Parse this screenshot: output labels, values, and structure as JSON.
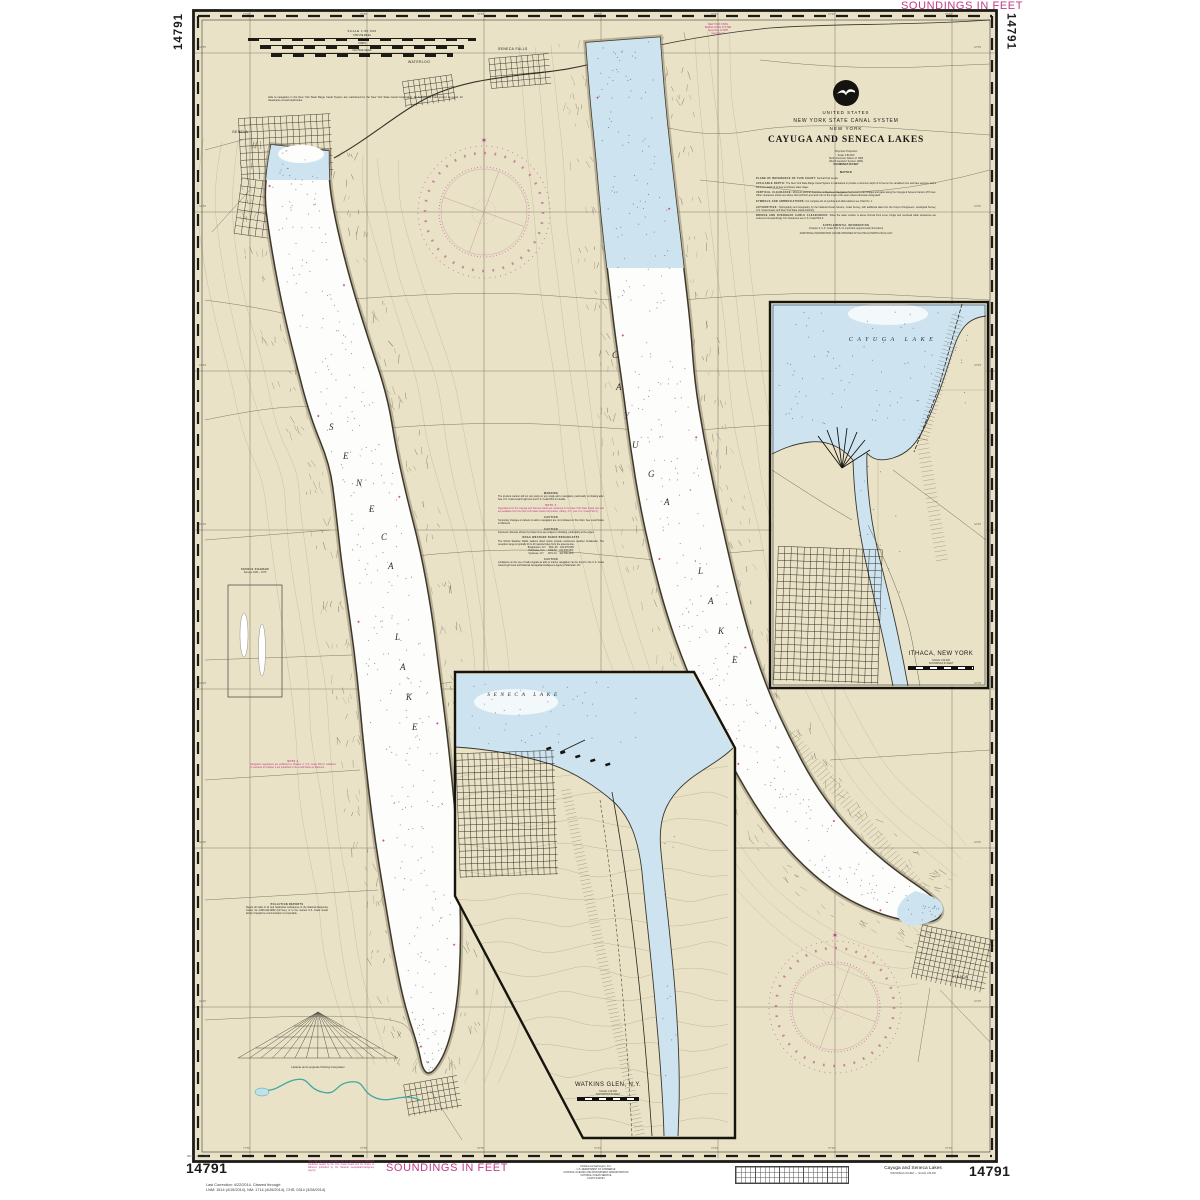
{
  "margins": {
    "top_left_number": "14791",
    "top_right_soundings": "SOUNDINGS IN FEET",
    "top_right_number": "14791",
    "bottom_left_edition": "4th Ed., Dec. '09",
    "bottom_left_number": "14791",
    "correction_line1": "Last Correction: 4/22/2014.  Cleared through:",
    "correction_line2": "LNM: 1514 (4/15/2014), NM: 1714 (4/26/2014), CHS: 0314 (3/28/2014)",
    "bottom_magenta_note": "This chart has been corrected from the Local Notice to Mariners published weekly by the U.S. Coast Guard and the Notice to Mariners published by the National Geospatial-Intelligence Agency.",
    "bottom_soundings": "SOUNDINGS IN FEET",
    "publisher_lines": [
      "Published at Washington, D.C.",
      "U.S. DEPARTMENT OF COMMERCE",
      "NATIONAL OCEANIC AND ATMOSPHERIC ADMINISTRATION",
      "NATIONAL OCEAN SERVICE",
      "COAST SURVEY"
    ],
    "bottom_right_title": "Cayuga and Seneca Lakes",
    "bottom_right_subtitle": "SOUNDINGS IN FEET — SCALE 1:80,000",
    "bottom_right_number": "14791"
  },
  "title_block": {
    "country": "UNITED STATES",
    "system": "NEW YORK STATE CANAL SYSTEM",
    "state": "NEW YORK",
    "title": "CAYUGA  AND  SENECA  LAKES",
    "projection_lines": [
      "Polyconic Projection",
      "Scale 1:80,000",
      "North American Datum of 1983",
      "(World Geodetic System 1984)",
      "SOUNDINGS IN FEET"
    ],
    "notes_header": "NOTES",
    "notes": [
      {
        "lead": "PLANE OF REFERENCE OF THIS CHART:",
        "body": " Normal Pool Levels."
      },
      {
        "lead": "AVAILABLE DEPTH:",
        "body": " The New York State Barge Canal System is maintained to provide a minimum depth of 12 feet in the canalized river and lake sections, and a minimum depth of 12 feet at ordinary water stage."
      },
      {
        "lead": "VERTICAL CLEARANCE:",
        "body": " Minimum vertical clearance at Maximum Navigable Pool Level under bridges and gates along the Cayuga & Seneca Canal is 15½ feet. Other clearances shown are above Normal Pool Level and refer to the mean of the span unless otherwise designated."
      },
      {
        "lead": "SYMBOLS AND ABBREVIATIONS:",
        "body": " For complete list of symbols and abbreviations see Chart No. 1."
      },
      {
        "lead": "AUTHORITIES:",
        "body": " Hydrography and topography by the National Ocean Service, Coast Survey, with additional data from the Corps of Engineers, Geological Survey, U.S. Coast Guard, and New York State Canal Authority."
      },
      {
        "lead": "BRIDGE AND OVERHEAD CABLE CLEARANCES:",
        "body": " When the water surface is above Normal Pool Level, bridge and overhead cable clearances are reduced correspondingly. For clearances see U.S. Coast Pilot 6."
      }
    ],
    "supplemental_header": "SUPPLEMENTAL INFORMATION",
    "supplemental_line": "(Chapter 9, U.S. Coast Pilot 6, for important supplemental information)",
    "supplemental_line2": "ADDITIONAL INFORMATION CAN BE OBTAINED AT NAUTICALCHARTS.NOAA.GOV"
  },
  "scale_block": {
    "scale": "SCALE 1:80,000",
    "bars": [
      "STATUTE MILES",
      "YARDS",
      "NAUTICAL MILES"
    ],
    "note": "Aids to navigation in the New York State Barge Canal System are maintained by the New York State Canal Corporation. All bridges are fixed except as noted; for clearances consult authorities."
  },
  "canal_note_lines": [
    "NEW YORK STATE",
    "BARGE CANAL SYSTEM",
    "Speed limit 10 MPH",
    "(see Note C)"
  ],
  "notes_center": {
    "blocks": [
      {
        "header": "WARNING",
        "body": "The prudent mariner will not rely solely on any single aid to navigation, particularly on floating aids. See U.S. Coast Guard Light List and U.S. Coast Pilot for details."
      },
      {
        "header": "NOTE C",
        "body": "Regulations for the Cayuga and Seneca Canal are contained in the New York State Canal Law and are available from the New York State Canal Corporation, Albany, N.Y. (see U.S. Coast Pilot 6)."
      },
      {
        "header": "CAUTION",
        "body": "Temporary changes or defects in aids to navigation are not indicated on this chart. See Local Notice to Mariners."
      },
      {
        "header": "CAUTION",
        "body": "Improved channels shown by broken lines are subject to shoaling, particularly at the edges."
      },
      {
        "header": "NOAA WEATHER RADIO BROADCASTS",
        "body": "The NOAA Weather Radio stations listed below provide continuous weather broadcasts. The reception range is typically 20 to 40 nautical miles from the antenna site.",
        "table": [
          "Binghamton, N.Y.    WXL-38    162.475 MHz",
          "Rochester, N.Y.     KHA-53    162.400 MHz",
          "Syracuse, N.Y.      WXL-31    162.550 MHz"
        ]
      },
      {
        "header": "CAUTION",
        "body": "Limitations on the use of radio signals as aids to marine navigation can be found in the U.S. Coast Guard Light Lists and National Geospatial-Intelligence Agency Publication 117."
      }
    ]
  },
  "side_notes": {
    "note_a_header": "NOTE A",
    "note_a_body": "Navigation regulations are published in Chapter 2, U.S. Coast Pilot 6. Additions or revisions to Chapter 2 are published in the Local Notice to Mariners.",
    "pollution_header": "POLLUTION REPORTS",
    "pollution_body": "Report all spills of oil and hazardous substances to the National Response Center via 1-800-424-8802 (toll free), or to the nearest U.S. Coast Guard facility if telephone communication is impossible.",
    "source_header": "SOURCE DIAGRAM",
    "source_sub": "Surveys 1934 – 1975",
    "interpolator_label": "Latitude and Longitude Plotting Interpolator"
  },
  "map_labels": {
    "seneca_lake": "SENECA LAKE",
    "cayuga_lake": "CAYUGA LAKE",
    "geneva": "GENEVA",
    "waterloo": "WATERLOO",
    "seneca_falls": "SENECA FALLS",
    "ithaca": "ITHACA"
  },
  "graticule": {
    "lon_labels": [
      "77°00'",
      "76°55'",
      "76°50'",
      "76°45'",
      "76°40'",
      "76°35'",
      "76°30'"
    ],
    "lat_labels": [
      "42°55'",
      "42°50'",
      "42°45'",
      "42°40'",
      "42°35'",
      "42°30'",
      "42°25'"
    ]
  },
  "insets": {
    "ithaca": {
      "lake_label": "CAYUGA  LAKE",
      "title": "ITHACA, NEW YORK",
      "scale": "SCALE 1:20,000",
      "soundings": "SOUNDINGS IN FEET"
    },
    "watkins": {
      "lake_label": "SENECA  LAKE",
      "title": "WATKINS GLEN, N.Y.",
      "scale": "SCALE 1:20,000",
      "soundings": "SOUNDINGS IN FEET"
    }
  },
  "colors": {
    "paper": "#ffffff",
    "land": "#e9e2c6",
    "water_shallow": "#cde4f0",
    "water_deep": "#fdfdfb",
    "magenta": "#c23a86",
    "ink": "#1c1b18"
  }
}
